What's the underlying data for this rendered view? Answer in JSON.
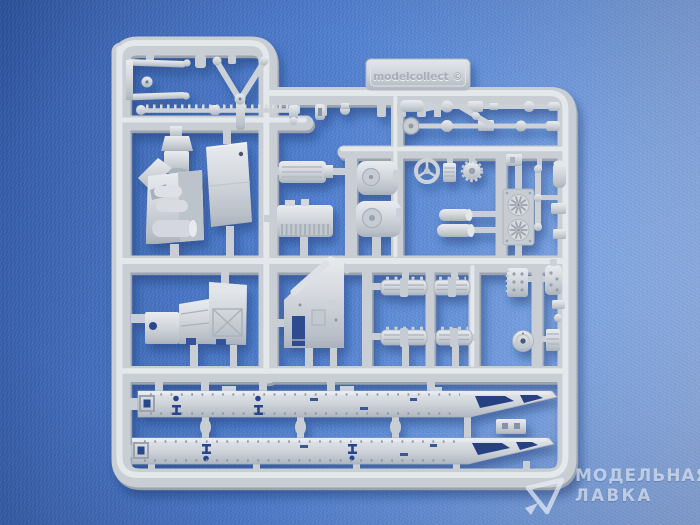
{
  "sprue_tab": {
    "embossed_text": "modelcollect ©"
  },
  "watermark": {
    "line1": "МОДЕЛЬНАЯ",
    "line2": "ЛАВКА"
  },
  "palette": {
    "fabric_dark": "#2d55a2",
    "fabric_mid": "#4d7ccd",
    "fabric_light": "#9dbcec",
    "plastic_light": "#e9edf0",
    "plastic_mid": "#c9ced5",
    "plastic_shadow": "#9aa3ae",
    "cast_shadow": "#14306b",
    "hole_dark": "#27448a",
    "watermark_text": "#ecf1f9"
  }
}
